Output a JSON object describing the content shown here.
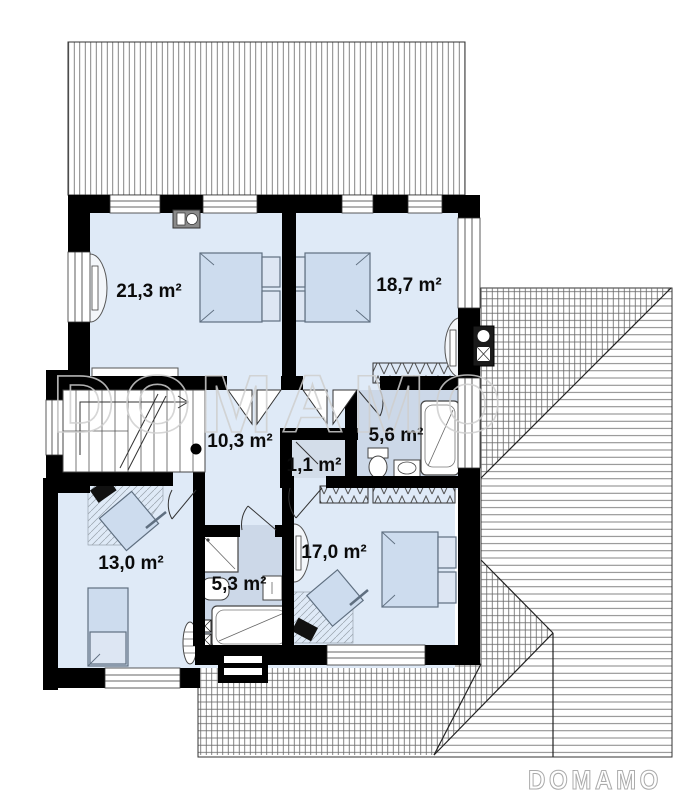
{
  "watermark_text": "DOMAMO",
  "logo_text": "DOMAMO",
  "rooms": [
    {
      "id": "bedroom-large",
      "area": "21,3 m²"
    },
    {
      "id": "bedroom-top-right",
      "area": "18,7 m²"
    },
    {
      "id": "hall",
      "area": "10,3 m²"
    },
    {
      "id": "closet",
      "area": "1,1 m²"
    },
    {
      "id": "bathroom-top",
      "area": "5,6 m²"
    },
    {
      "id": "bedroom-bottom-left",
      "area": "13,0 m²"
    },
    {
      "id": "bathroom-bottom",
      "area": "5,3 m²"
    },
    {
      "id": "bedroom-bottom-right",
      "area": "17,0 m²"
    }
  ],
  "colors": {
    "wall": "#000000",
    "room_floor": "#dfeaf7",
    "bath_floor": "#ccd8e8",
    "furniture_fill": "#cddcee",
    "furniture_stroke": "#5f6f80",
    "roof_hatch": "#666666",
    "watermark": "#cfcfcf"
  }
}
